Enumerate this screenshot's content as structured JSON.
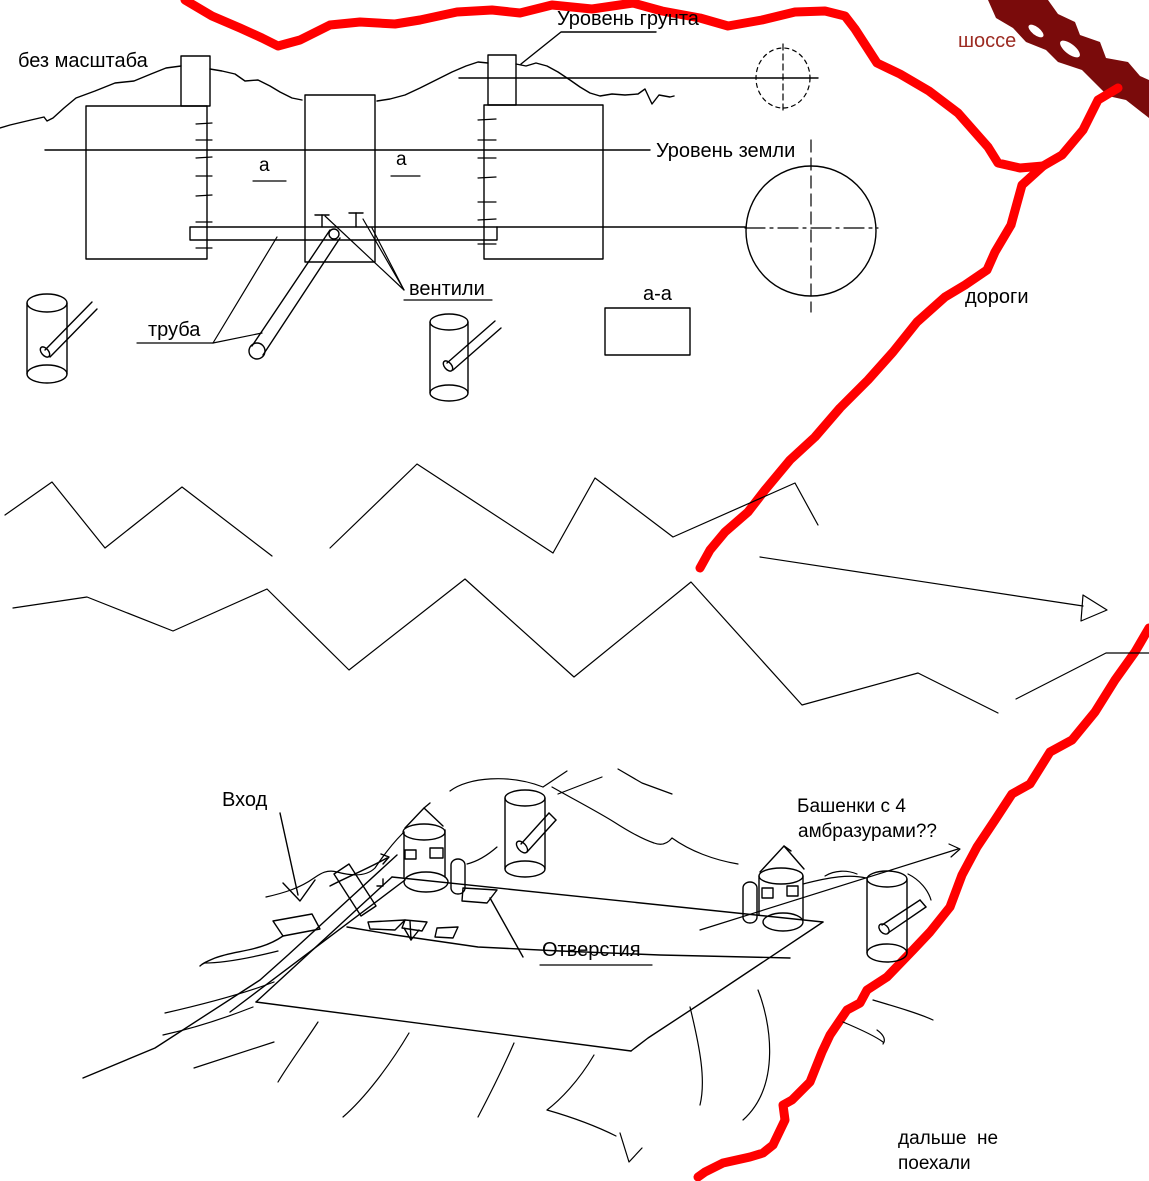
{
  "colors": {
    "ink": "#000000",
    "road": "#FF0000",
    "highway": "#7A0B0B",
    "highway_text": "#9C2B22",
    "background": "#FFFFFF"
  },
  "annotations": {
    "no_scale": "без масштаба",
    "ground_surface_level": "Уровень грунта",
    "earth_level": "Уровень земли",
    "valves": "вентили",
    "pipe": "труба",
    "section_mark_a_left": "а",
    "section_mark_a_right": "а",
    "section_a_a": "а-а",
    "highway": "шоссе",
    "roads": "дороги",
    "entrance": "Вход",
    "turrets_line1": "Башенки с 4",
    "turrets_line2": "амбразурами??",
    "openings": "Отверстия",
    "no_further_line1": "дальше  не",
    "no_further_line2": "поехали"
  }
}
